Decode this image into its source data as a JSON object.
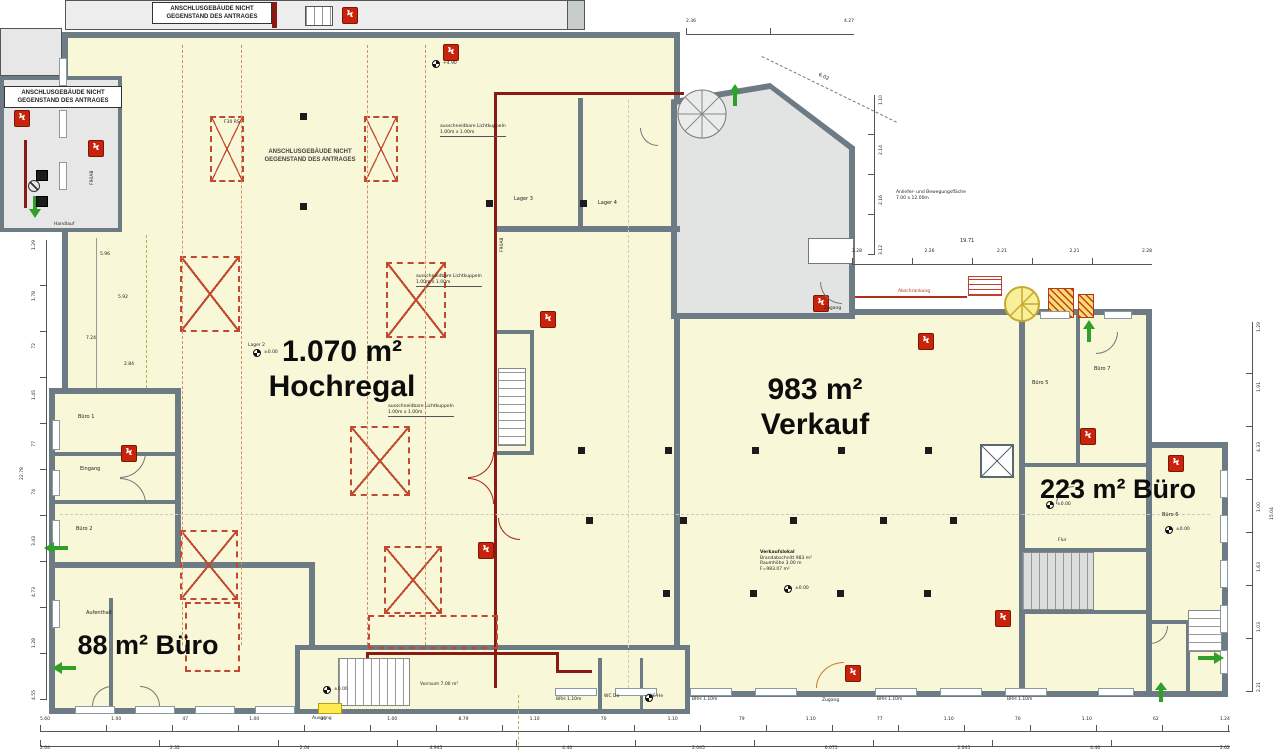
{
  "annex_note": {
    "l1": "ANSCHLUSGEBÄUDE NICHT",
    "l2": "GEGENSTAND DES ANTRAGES"
  },
  "big": {
    "hochregal_area": "1.070 m²",
    "hochregal_name": "Hochregal",
    "verkauf_area": "983 m²",
    "verkauf_name": "Verkauf",
    "buero223": "223 m² Büro",
    "buero88": "88 m² Büro"
  },
  "rooms": {
    "lager2": "Lager 2",
    "lager3": "Lager 3",
    "lager4": "Lager 4",
    "buero1": "Büro 1",
    "eingang": "Eingang",
    "buero2": "Büro 2",
    "aufenthalt": "Aufenthalt",
    "vorraum": "Vorraum 7.00 m²",
    "wc1": "WC Da",
    "wc2": "WC He",
    "buero5": "Büro 5",
    "buero7": "Büro 7",
    "buero6": "Büro 6",
    "flur": "Flur",
    "handlauf": "Handlauf"
  },
  "ann": {
    "lk1": "ausschneidbare Lichtkuppeln",
    "lk2": "1.00m x 1.00m",
    "vk1": "Verkaufslokal",
    "vk2": "Brandabschnitt 983 m²",
    "vk3": "Raumhöhe 3.00 m",
    "vk4": "F=983.07 m²",
    "al1": "Anliefer- und Bewegungsfläche",
    "al2": "7.00 x 12.00m",
    "abschrankung": "Abschrankung",
    "zugang": "Zugang",
    "ausgang": "Ausgang",
    "brh": "BRH 1.10m",
    "lvl0": "±0.00",
    "lvl490": "+4.90",
    "f90": "F90AB",
    "f30": "F30 RS"
  },
  "dims": {
    "b1": [
      "5.60",
      "1.00",
      "47",
      "1.00",
      "05",
      "1.00",
      "8.79",
      "1.10",
      "70",
      "1.10",
      "79",
      "1.10",
      "77",
      "1.10",
      "70",
      "1.10",
      "62",
      "1.24"
    ],
    "b2": [
      "2.04",
      "2.32",
      "2.04",
      "4.945",
      "4.40",
      "2.045",
      "6.075",
      "2.045",
      "4.46",
      "2.62"
    ],
    "left": [
      "1.29",
      "1.78",
      "72",
      "1.45",
      "77",
      "74",
      "3.43",
      "4.73",
      "1.28",
      "4.55"
    ],
    "left_total": "22.78",
    "right": [
      "1.29",
      "1.91",
      "4.33",
      "1.00",
      "1.63",
      "1.03",
      "2.21"
    ],
    "right_total": "15.04",
    "trh": [
      "2.28",
      "2.26",
      "2.21",
      "2.21",
      "2.28"
    ],
    "trh_total": "19.71",
    "trtop": [
      "2.36",
      "4.27"
    ],
    "slant": "6.02",
    "trv": [
      "1.10",
      "2.14",
      "2.16",
      "3.12"
    ],
    "sl": [
      "5.96",
      "5.92",
      "7.24",
      "2.84"
    ]
  }
}
